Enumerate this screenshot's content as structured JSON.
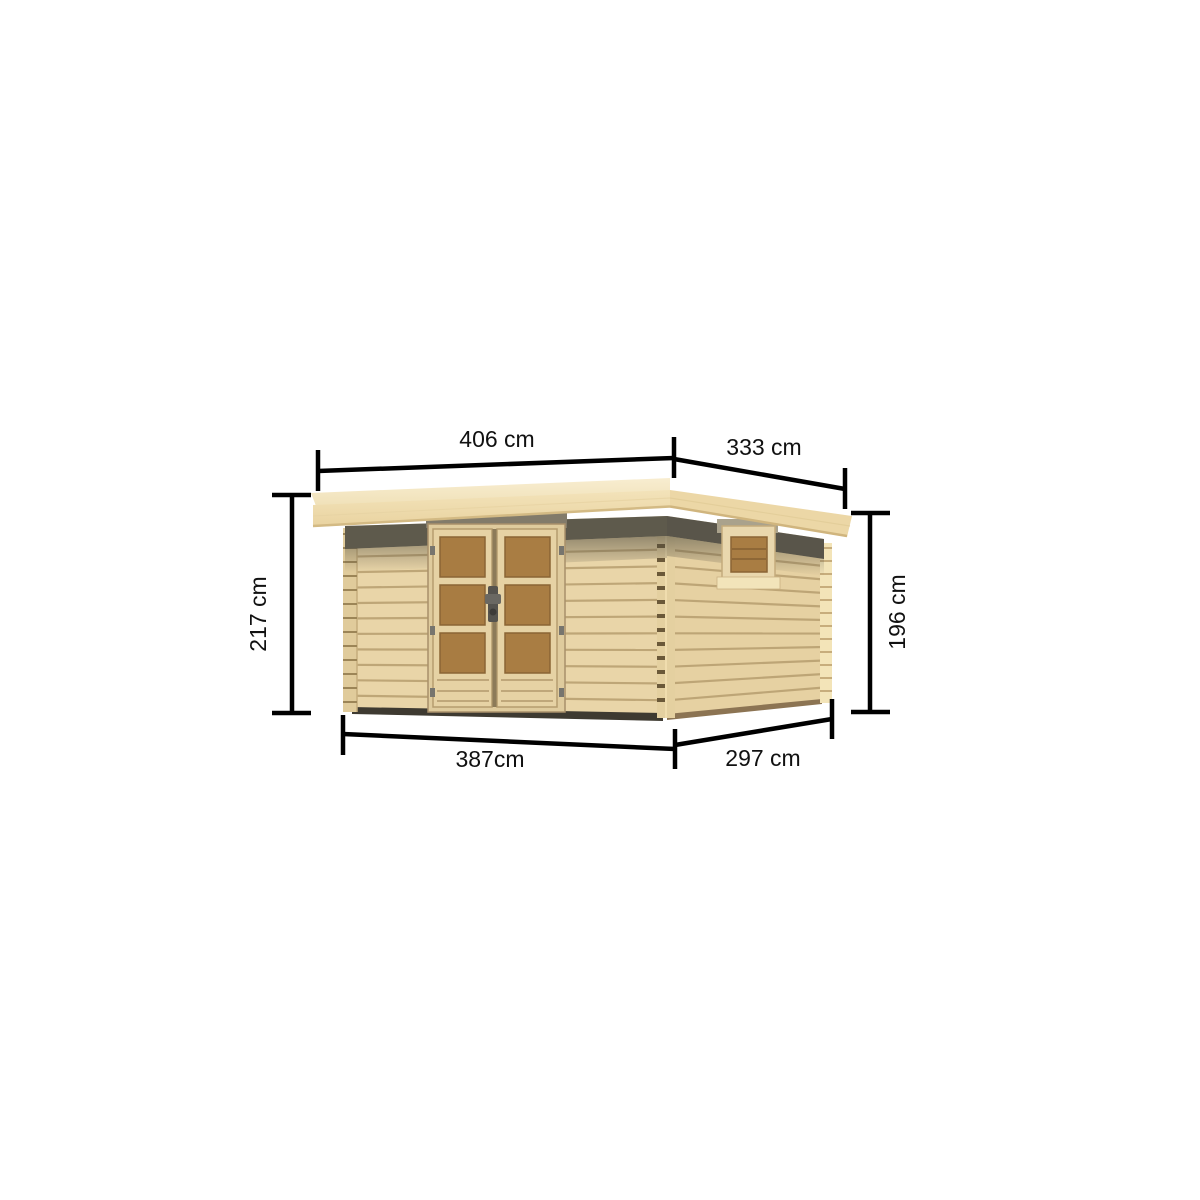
{
  "page": {
    "background": "#ffffff",
    "description": "Product dimension diagram of a flat-roof wooden garden shed with a double glazed door on the front and a small window on the right side wall"
  },
  "diagram": {
    "subject": "wooden garden shed",
    "unit": "cm",
    "dimensions": {
      "roof_width_label": "406 cm",
      "roof_depth_label": "333 cm",
      "overall_height_label": "217 cm",
      "wall_height_label": "196 cm",
      "base_width_label": "387cm",
      "base_depth_label": "297 cm"
    },
    "colors": {
      "dimension_line": "#000000",
      "roof_wood": "#f4e7c6",
      "roof_face_wood": "#efddb0",
      "wall_wood": "#e9d5a8",
      "door_glass_wood": "#a87c42",
      "under_roof_shadow": "#5e5a4c",
      "background": "#ffffff"
    }
  }
}
